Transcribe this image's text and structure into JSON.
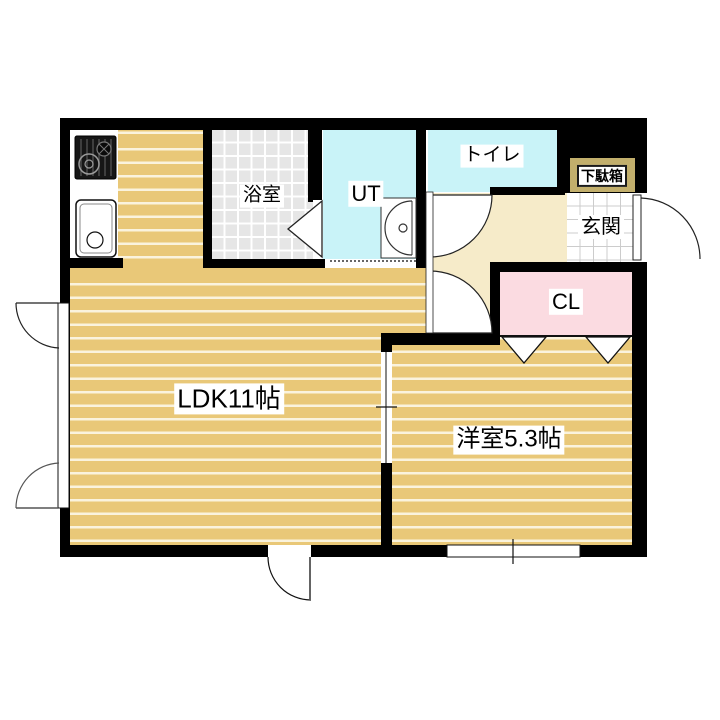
{
  "plan": {
    "type": "apartment-floor-plan",
    "rooms": {
      "ldk": {
        "label": "LDK11帖"
      },
      "western_room": {
        "label": "洋室5.3帖"
      },
      "bathroom": {
        "label": "浴室"
      },
      "utility": {
        "label": "UT"
      },
      "toilet": {
        "label": "トイレ"
      },
      "entrance": {
        "label": "玄関"
      },
      "shoe_cabinet": {
        "label": "下駄箱"
      },
      "closet": {
        "label": "CL"
      }
    },
    "colors": {
      "wall": "#000000",
      "wood": "#e9c878",
      "woodline": "#faf3dd",
      "cyan": "#c9f3f8",
      "cream": "#f6ebc9",
      "pink": "#fbdbe1",
      "khaki": "#c2af6c",
      "bathtile": "#e6e6e6",
      "tileline": "#cccccc"
    }
  }
}
